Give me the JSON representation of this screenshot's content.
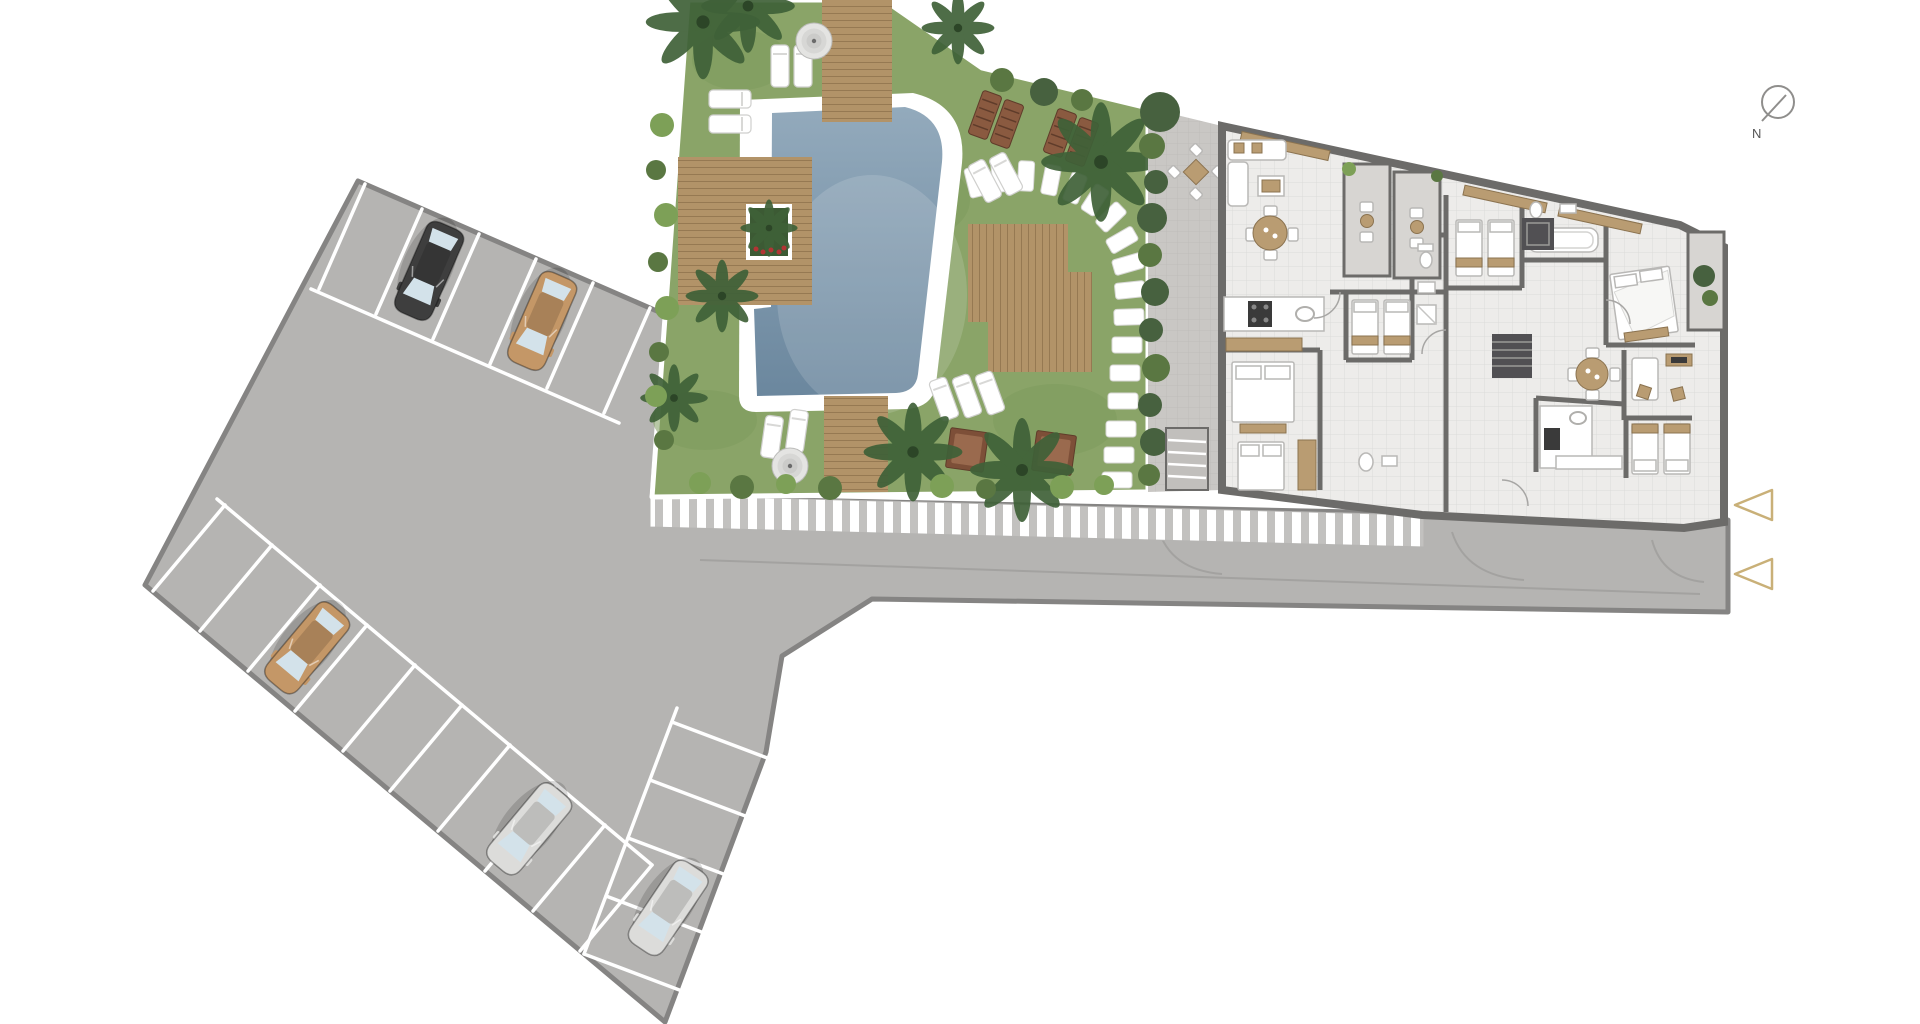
{
  "title": "residential-site-plan",
  "compass": {
    "label": "N"
  },
  "objects": {
    "cars": [
      {
        "name": "car-parked-black",
        "color": "car_black",
        "area": "upper-row"
      },
      {
        "name": "car-parked-tan-upper",
        "color": "car_tan",
        "area": "upper-row"
      },
      {
        "name": "car-parked-tan-lower",
        "color": "car_tan",
        "area": "lower-left-row"
      },
      {
        "name": "car-parked-silver-upper",
        "color": "car_silver",
        "area": "lower-left-row"
      },
      {
        "name": "car-parked-silver-lower",
        "color": "car_silver",
        "area": "lower-right-row"
      }
    ],
    "parasols": 2,
    "entry_markers": 2,
    "stepping_stones": 17,
    "balcony_dining_sets": 3
  },
  "colors": {
    "asphalt": "#b5b4b2",
    "asphalt_edge": "#858483",
    "bay_line": "#ffffff",
    "grass": "#8aa468",
    "grass_shade": "#7d9a5c",
    "pool": "#8fa7ba",
    "pool_deep": "#6b879e",
    "pool_deck": "#ffffff",
    "deck": "#b29368",
    "deck_dark": "#8f7451",
    "walk_base": "#c2c1bf",
    "walk_stripe": "#ffffff",
    "road_mark": "#a3a2a0",
    "terrace": "#c9c7c4",
    "hedge": "#47613f",
    "bush": "#7da057",
    "bush_dark": "#5a7742",
    "palm": "#3f6138",
    "floor": "#edecea",
    "wall": "#6c6b69",
    "balcony": "#d7d5d2",
    "wood": "#b99c72",
    "wood_dark": "#8b7350",
    "fixture_stroke": "#b9b8b6",
    "stove": "#3a3a3a",
    "stair": "#515053",
    "white": "#ffffff",
    "glass": "#d3e2ea",
    "car_black": "#3e3e3e",
    "car_tan": "#c49767",
    "car_silver": "#dcdcda",
    "lounger_brown": "#8a5a40",
    "daybed": "#7d4f38",
    "planter": "#3c5a34",
    "flower": "#b23434",
    "marker": "#c9b078",
    "compass": "#8f8e8c",
    "ink": "#555555"
  }
}
